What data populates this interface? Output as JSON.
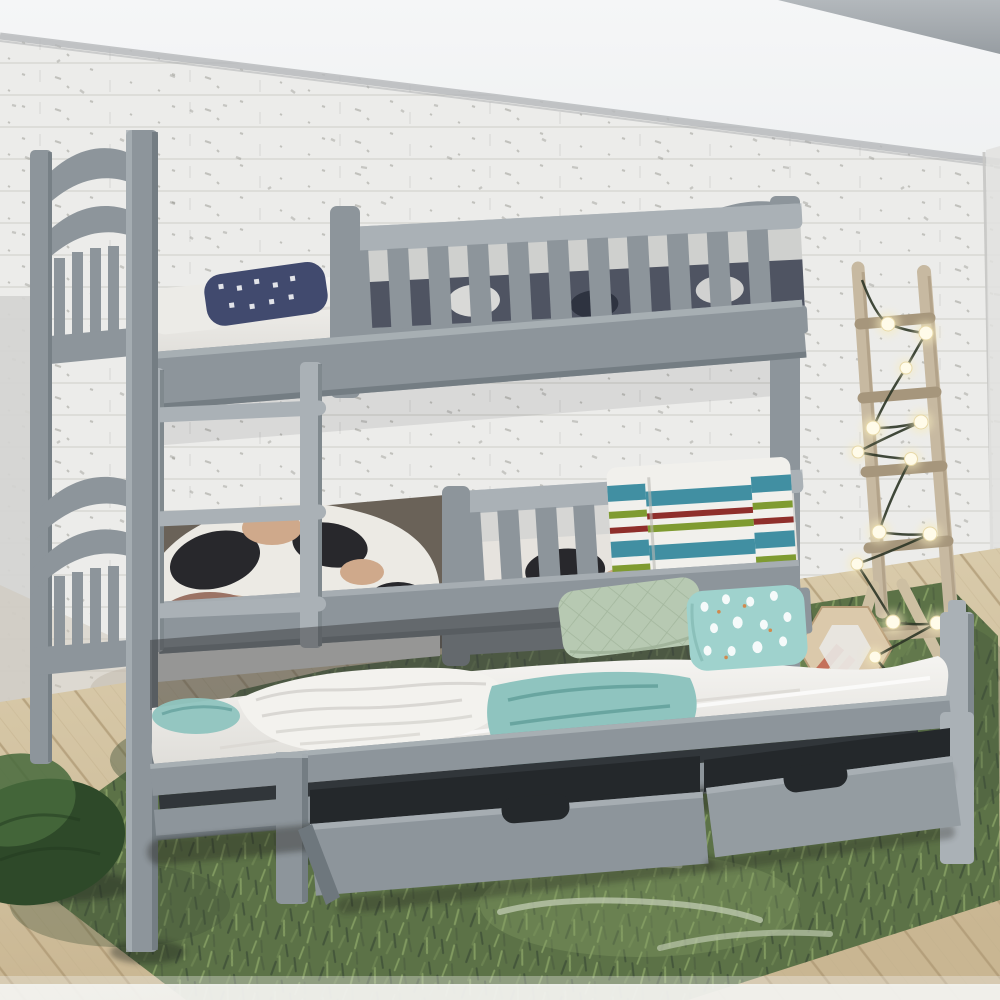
{
  "meta": {
    "type": "photograph",
    "description": "Lifestyle product photo of a grey wooden bunk bed with guard rails, ladder, pull-out trundle bed and two open storage drawers, styled against a white painted brick wall with a decorative wooden ladder wrapped in string lights, a hexagonal wood decoration, a dark green bean bag, a green shaggy rug and a light wood floor."
  },
  "scene": {
    "objects": [
      "white-brick-wall",
      "concrete-ceiling",
      "grey-bunk-bed",
      "upper-bunk-guard-rail",
      "lower-bunk-guard-rail",
      "bunk-ladder",
      "arched-headboards",
      "pull-out-trundle-bed",
      "storage-drawer-left",
      "storage-drawer-right",
      "white-mattress",
      "navy-patterned-pillow",
      "cow-print-bedding",
      "brown-ribbed-cushion",
      "rose-cushion",
      "striped-towels",
      "teal-blanket",
      "white-crinkled-throw",
      "sage-quilted-pillow",
      "teal-patterned-pillow",
      "decorative-wooden-ladder",
      "string-lights",
      "hexagon-wood-decor",
      "wooden-a-frame",
      "green-bean-bag",
      "green-shaggy-rug",
      "wood-floor"
    ]
  },
  "colors": {
    "ceiling_white": "#f5f6f7",
    "wall_white": "#ececea",
    "wall_brick_line": "#d9d9d5",
    "wall_speckle": "#6f6f68",
    "trim_grey": "#b5b8ba",
    "concrete_grey": "#979da2",
    "concrete_grey_light": "#b3b8bc",
    "plaster_left": "#d4d4d1",
    "wall_worn": "#cdc6b8",
    "bed_grey": "#8d959b",
    "bed_grey_light": "#aab1b6",
    "bed_grey_dark": "#6e777d",
    "bed_grey_deep": "#4e555a",
    "mattress_white": "#f5f4f1",
    "mattress_shadow": "#d9d7d2",
    "floor_wood": "#c9b692",
    "floor_wood_dark": "#ab9671",
    "floor_wood_light": "#dccfb0",
    "rug_green": "#5c7247",
    "rug_green_dark": "#42543a",
    "rug_green_light": "#859e63",
    "rug_worn": "#bcc7ad",
    "bean_bag_green": "#2e4929",
    "bean_bag_light": "#466a3c",
    "ladder_wood": "#c7b9a1",
    "ladder_wood_dark": "#a6967c",
    "hexagon_wood": "#dbc9ab",
    "hexagon_stripe": "#c4705a",
    "hexagon_stripe_light": "#d99b82",
    "light_glow": "#f7edc0",
    "light_core": "#fffbe9",
    "wire_green": "#2c3526",
    "towel_white": "#f1f0ec",
    "towel_teal": "#418fa2",
    "towel_olive": "#7f9b31",
    "towel_red": "#8f2f2b",
    "blanket_teal": "#8fc4bf",
    "blanket_teal_dark": "#5f9d98",
    "pillow_sage": "#b7c9b2",
    "pillow_sage_dark": "#9cb096",
    "pillow_teal": "#9fd2cd",
    "pillow_navy": "#414a6e",
    "pillow_white": "#ecebe7",
    "cow_white": "#eceae4",
    "cow_black": "#28282c",
    "cow_tan": "#cfa98b",
    "cushion_brown": "#5a3a26",
    "cushion_brown_dark": "#3e2715",
    "cushion_rose": "#9b7365",
    "drawer_interior": "#24282b",
    "shadow_dark": "#2e3236"
  }
}
